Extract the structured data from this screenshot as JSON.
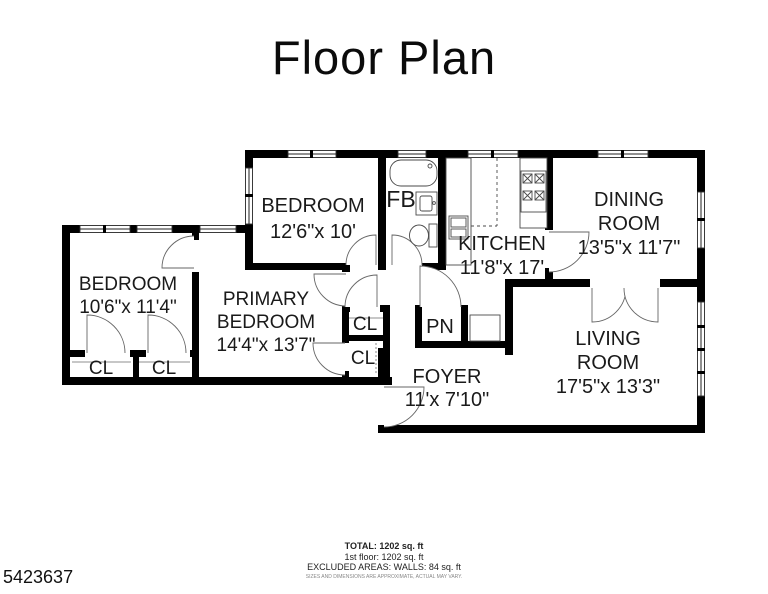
{
  "title": "Floor Plan",
  "rooms": {
    "bedroom_top": {
      "name": "BEDROOM",
      "dims": "12'6\"x 10'"
    },
    "full_bath": {
      "name": "FB"
    },
    "kitchen": {
      "name": "KITCHEN",
      "dims": "11'8\"x 17'"
    },
    "dining": {
      "line1": "DINING",
      "line2": "ROOM",
      "dims": "13'5\"x 11'7\""
    },
    "living": {
      "line1": "LIVING",
      "line2": "ROOM",
      "dims": "17'5\"x 13'3\""
    },
    "foyer": {
      "name": "FOYER",
      "dims": "11'x 7'10\""
    },
    "bedroom_left": {
      "name": "BEDROOM",
      "dims": "10'6\"x 11'4\""
    },
    "primary": {
      "line1": "PRIMARY",
      "line2": "BEDROOM",
      "dims": "14'4\"x 13'7\""
    },
    "closet_left_1": "CL",
    "closet_left_2": "CL",
    "hall_closet_1": "CL",
    "hall_closet_2": "CL",
    "pantry": "PN"
  },
  "footer": {
    "total": "TOTAL: 1202 sq. ft",
    "floor": "1st floor: 1202 sq. ft",
    "excluded": "EXCLUDED AREAS: WALLS: 84 sq. ft",
    "disclaimer": "SIZES AND DIMENSIONS ARE APPROXIMATE, ACTUAL MAY VARY."
  },
  "photo_id": "5423637",
  "colors": {
    "wall": "#000000",
    "background": "#ffffff",
    "fixture_line": "#4a4a4a"
  }
}
